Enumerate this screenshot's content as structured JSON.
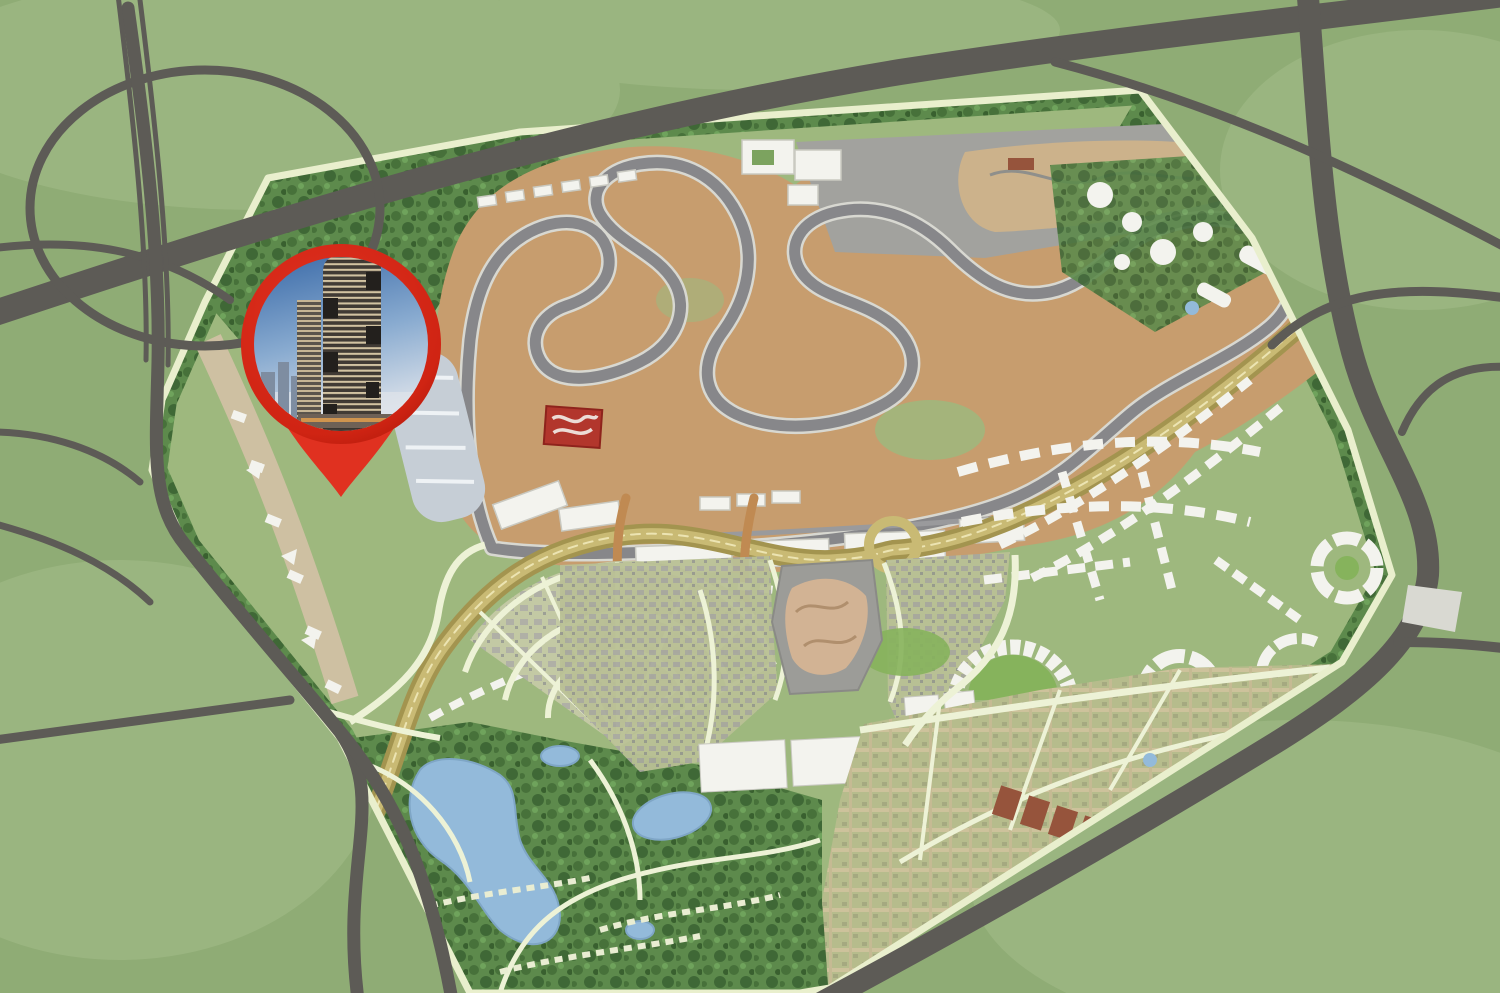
{
  "meta": {
    "kind": "aerial-masterplan-map",
    "description": "Rendered aerial master plan of a motorsport city development with a grand-prix circuit, surrounded by highways, with a red location pin showing a high-rise tower photo",
    "text_content": "none - graphical map only"
  },
  "palette": {
    "grass_outer": "#8fac75",
    "grass_light": "#a9c28f",
    "highway": "#5d5b56",
    "highway_soft": "#6c6a64",
    "site_green": "#9eb87e",
    "tree_dark": "#47703a",
    "boundary_road": "#e9efcd",
    "path_cream": "#edf2d6",
    "service_strip": "#cec0a2",
    "track_sand": "#c79d6e",
    "track_asphalt": "#87878a",
    "track_edge": "#d8d8d1",
    "kart_paddock": "#a2a29e",
    "kart_sand": "#ccb28b",
    "building_white": "#f3f3ee",
    "building_shadow": "#c9c9c1",
    "logo_red": "#b2362c",
    "boulevard_dark": "#a3944f",
    "boulevard_light": "#c9ba74",
    "boulevard_line": "#ece4b2",
    "bridge_tan": "#c08a52",
    "water": "#93bada",
    "water_edge": "#7fa6c6",
    "suburb_street": "#cdc29b",
    "brick_red": "#96543c",
    "plot_gray": "#9c9c98",
    "plot_tan": "#d2b394",
    "lawn": "#86b35c",
    "grandstand_blue": "#c6ced6",
    "outside_patch": "#d9d9d2",
    "pin_red": "#e03120",
    "pin_red_deep": "#b31a0c",
    "sky_top": "#3a6aa8",
    "sky_mid": "#89abd0",
    "sky_low": "#d9e0e9",
    "tower_dark": "#413b35",
    "tower_stripe": "#d2c3a2",
    "podium_glow": "#d99a4e"
  },
  "pin": {
    "type": "location-marker",
    "center": {
      "x": 341,
      "y": 344
    },
    "outer_radius": 100,
    "photo_radius": 87,
    "tip": {
      "x": 341,
      "y": 497
    },
    "photo_subject": "striped high-rise tower render against blue sky"
  },
  "features": [
    "cloverleaf highway interchange (top-left)",
    "diagonal expressway across the top",
    "multi-ramp highway junction (top-right)",
    "perimeter tree belt around site",
    "grand-prix circuit with sand run-off areas",
    "karting and paddock zone",
    "pit buildings and grandstands",
    "red circuit logo painted on tarmac",
    "curved golden spine boulevard with interchange loop",
    "fan-shaped residential district",
    "central attraction plot with animal-shaped landscaping",
    "business park with circular and crescent plazas",
    "suburban street-grid district",
    "villa park with lakes and winding paths",
    "red location pin with tower photograph"
  ]
}
